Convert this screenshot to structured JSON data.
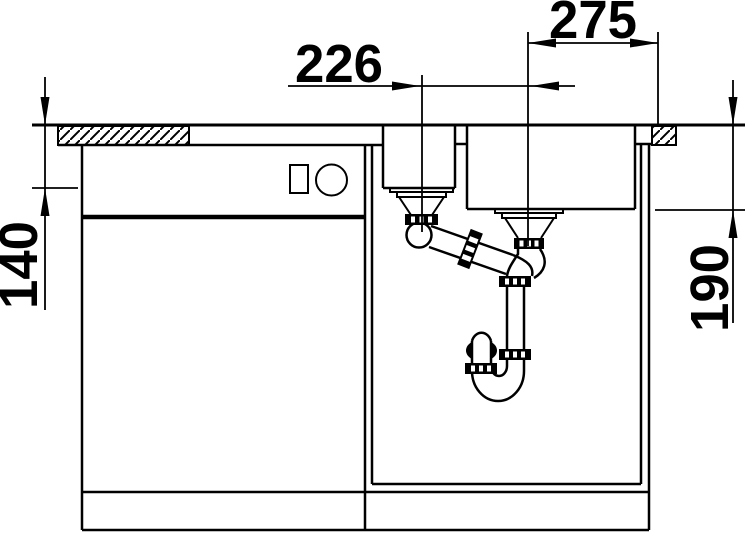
{
  "diagram": {
    "kind": "technical-drawing",
    "subject": "Kitchen sink installation cross-section with two bowls, base cabinet and space-saving siphon",
    "background_color": "#ffffff",
    "line_color": "#000000"
  },
  "dims": {
    "drain_spacing": "226",
    "drain_to_edge": "275",
    "left_bowl_depth": "140",
    "right_bowl_depth": "190"
  }
}
